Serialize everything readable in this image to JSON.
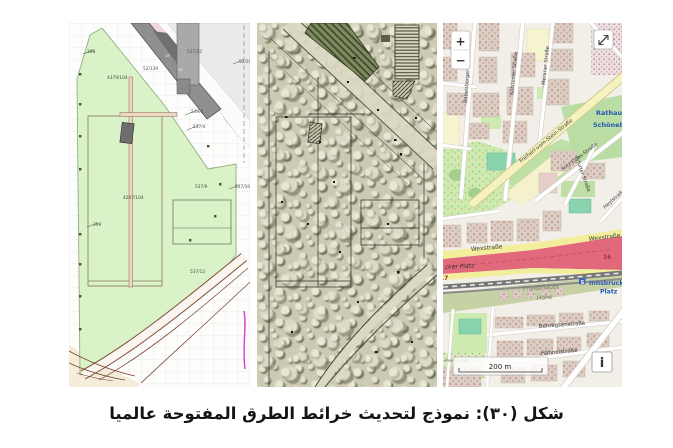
{
  "figure": {
    "caption": "شكل (٣٠): نموذج لتحديث خرائط الطرق المفتوحة عالميا"
  },
  "panels": {
    "cadastral": {
      "labels": {
        "l398": "398",
        "l399": "399",
        "l4379": "4379/104",
        "l52_139": "52/139",
        "l537_22": "537/22",
        "l52_20": "52/20",
        "l539_8": "539/8",
        "l537_4": "537/4",
        "l537_9": "537/9",
        "l537_10": "537/10",
        "l4267": "4267/104",
        "l537_12": "537/12",
        "b18": "18",
        "b16": "16"
      }
    },
    "osm": {
      "controls": {
        "zoom_in": "+",
        "zoom_out": "−",
        "info": "i",
        "scale_label": "200 m"
      },
      "streets": {
        "babelsberger": "Babelsberger Straße",
        "kufsteiner": "Kufsteiner Straße",
        "meraner": "Meraner Straße",
        "freiherr": "Freiherr-vom-Stein-Straße",
        "fritz_elsas": "Fritz-Elsas-Straße",
        "erfurter": "Erfurter Straße",
        "heyl": "Heylstraße",
        "wex1": "Wexstraße",
        "wex2": "Wexstraße",
        "bennigsen": "Bennigsenstraße",
        "haehnel": "Hähnelstraße",
        "perelsplatz": "Perelsplatz"
      },
      "places": {
        "rathaus1": "Rathaus",
        "rathaus2": "Schöneberg",
        "innsbrucker1": "Innsbrucker",
        "innsbrucker2": "Platz",
        "platz_cut": "cker Platz",
        "friedenauer1": "Friedenauer",
        "friedenauer2": "Höhe",
        "ref16": "16",
        "ref17": "17",
        "sbahn": "S"
      },
      "colors": {
        "motorway_pink": "#e2697b",
        "road_yellow": "#f2ee9b",
        "park_green": "#cdebb0",
        "pitch_teal": "#8ad3af",
        "building_tan": "#d8cec5",
        "station_blue": "#2859b8",
        "background": "#f2efe9"
      }
    }
  }
}
